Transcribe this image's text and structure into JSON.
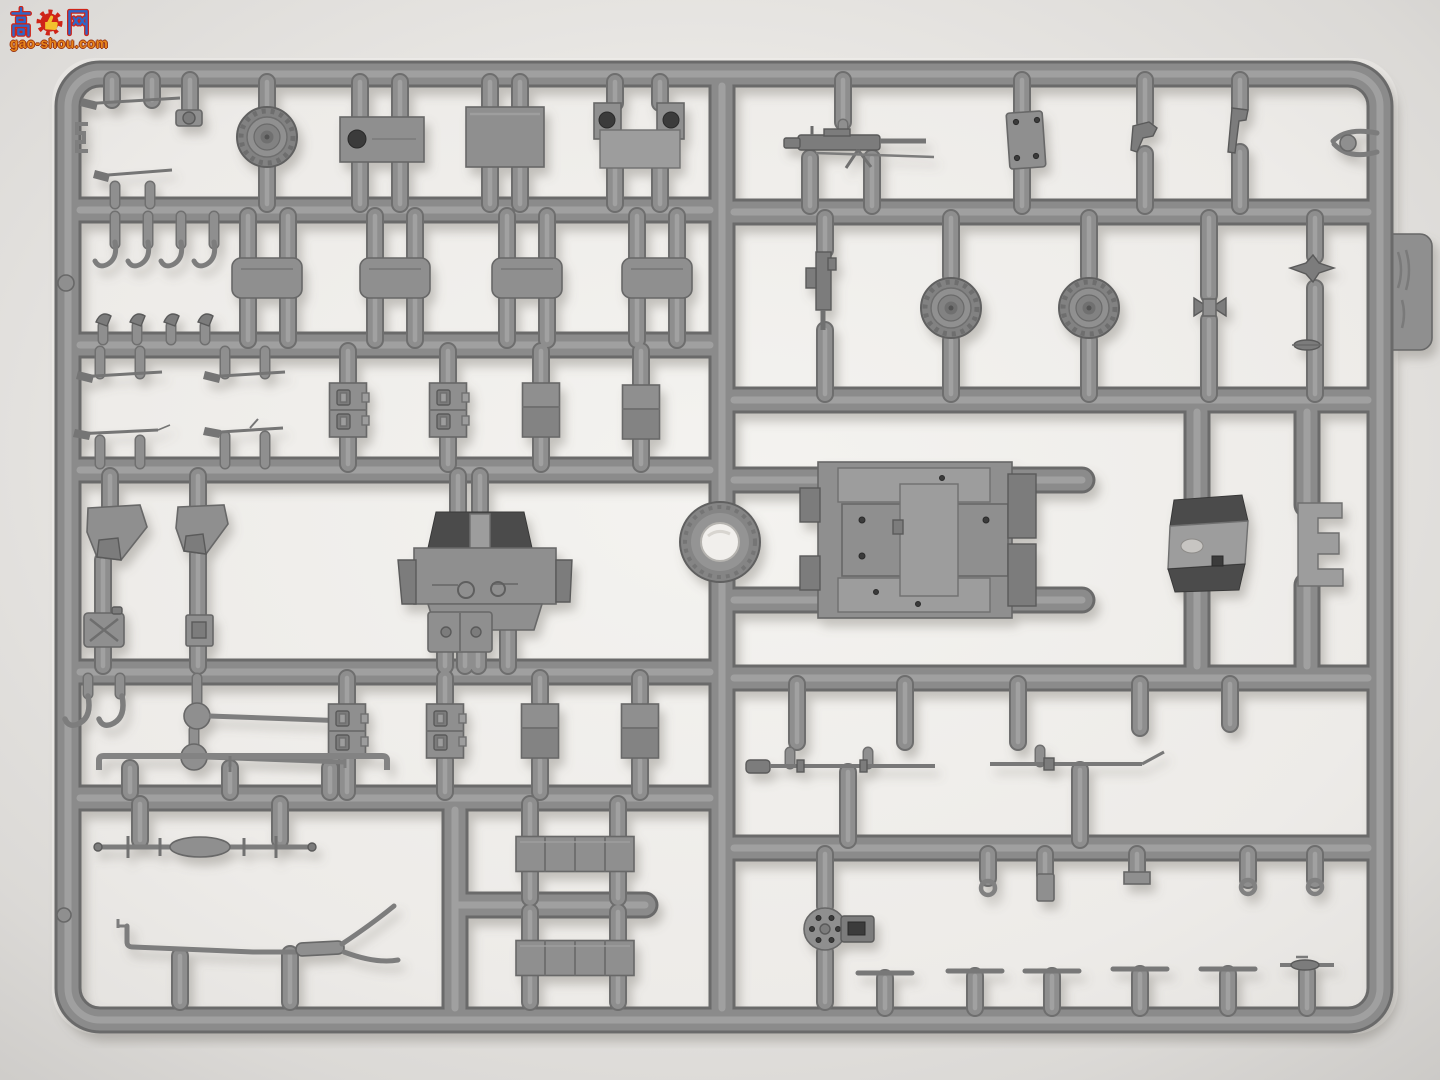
{
  "watermark": {
    "char_left": "高",
    "char_right": "网",
    "site_url": "gao-shou.com",
    "colors": {
      "glyph_blue": "#2f66c8",
      "glyph_outline_red": "#cf2418",
      "gear_red": "#cf2418",
      "thumb_yellow": "#f2c12e",
      "url_orange": "#e8861c"
    }
  },
  "photo": {
    "plastic_gray": "#8a8a8a",
    "paper_white": "#f2f1ee",
    "backdrop_gray": "#d9d7d4"
  }
}
